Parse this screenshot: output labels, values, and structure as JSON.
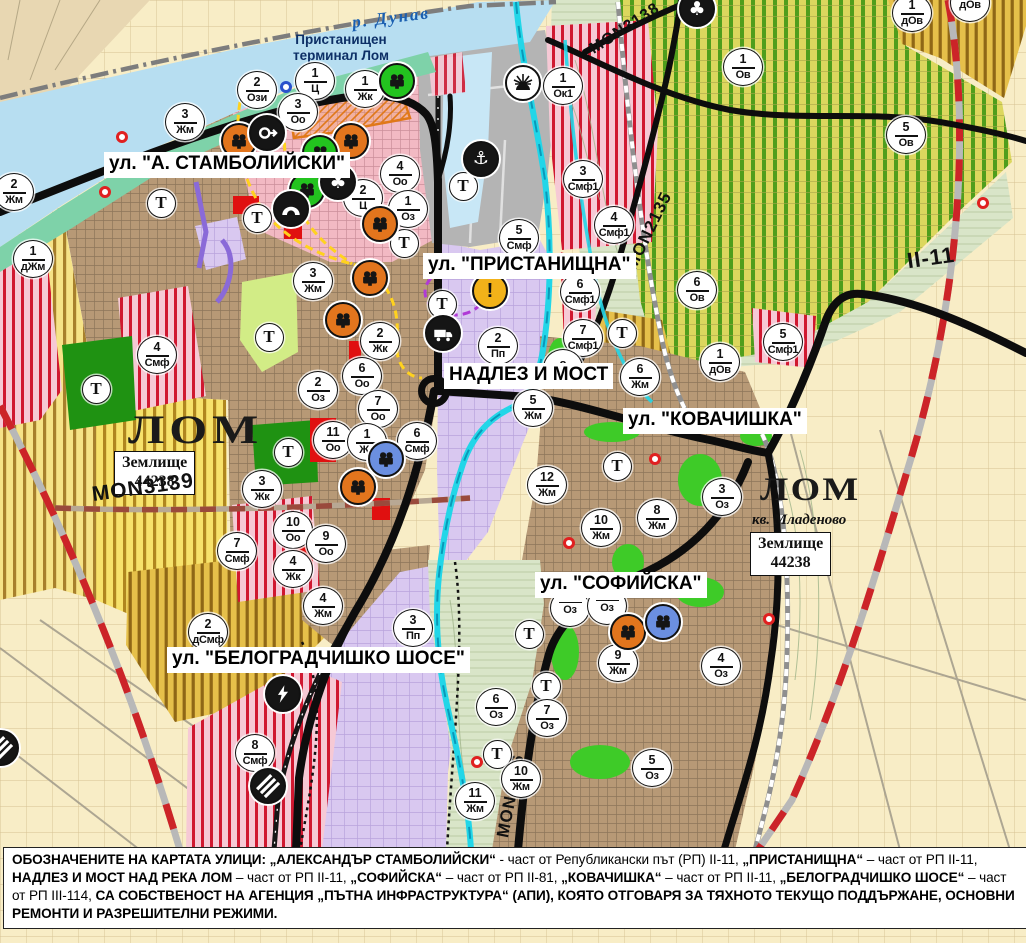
{
  "map": {
    "t_letter": "Т",
    "places": {
      "danube": "р. Дунав",
      "terminal_line1": "Пристанищен",
      "terminal_line2": "терминал Лом",
      "lom": "ЛОМ",
      "mladenovo": "кв. Младеново",
      "zemlishte_word": "Землище",
      "zemlishte_number": "44238"
    },
    "street_labels": [
      {
        "text": "ул. \"А. СТАМБОЛИЙСКИ\"",
        "x": 104,
        "y": 152
      },
      {
        "text": "ул. \"ПРИСТАНИЩНА\"",
        "x": 423,
        "y": 253
      },
      {
        "text": "НАДЛЕЗ И МОСТ",
        "x": 444,
        "y": 363
      },
      {
        "text": "ул. \"КОВАЧИШКА\"",
        "x": 623,
        "y": 408
      },
      {
        "text": "ул. \"СОФИЙСКА\"",
        "x": 535,
        "y": 572
      },
      {
        "text": "ул. \"БЕЛОГРАДЧИШКО ШОСЕ\"",
        "x": 167,
        "y": 647
      }
    ],
    "road_labels": [
      {
        "text": "MON3139",
        "x": 143,
        "y": 490,
        "rot": -8,
        "fs": 21
      },
      {
        "text": "MON2135",
        "x": 649,
        "y": 232,
        "rot": -64,
        "fs": 17
      },
      {
        "text": "MON3138",
        "x": 625,
        "y": 30,
        "rot": -33,
        "fs": 16
      },
      {
        "text": "MON2136",
        "x": 511,
        "y": 797,
        "rot": -79,
        "fs": 17
      },
      {
        "text": "II-11",
        "x": 931,
        "y": 259,
        "rot": -8,
        "fs": 22
      }
    ],
    "zone_markers": [
      {
        "x": 14,
        "y": 192,
        "n": "2",
        "c": "Жм"
      },
      {
        "x": 33,
        "y": 259,
        "n": "1",
        "c": "дЖм"
      },
      {
        "x": 185,
        "y": 122,
        "n": "3",
        "c": "Жм"
      },
      {
        "x": 257,
        "y": 90,
        "n": "2",
        "c": "Ози"
      },
      {
        "x": 315,
        "y": 81,
        "n": "1",
        "c": "Ц"
      },
      {
        "x": 365,
        "y": 89,
        "n": "1",
        "c": "Жк"
      },
      {
        "x": 298,
        "y": 112,
        "n": "3",
        "c": "Оо"
      },
      {
        "x": 400,
        "y": 174,
        "n": "4",
        "c": "Оо"
      },
      {
        "x": 363,
        "y": 198,
        "n": "2",
        "c": "Ц"
      },
      {
        "x": 408,
        "y": 209,
        "n": "1",
        "c": "Оз"
      },
      {
        "x": 563,
        "y": 86,
        "n": "1",
        "c": "Ок1"
      },
      {
        "x": 583,
        "y": 179,
        "n": "3",
        "c": "Смф1"
      },
      {
        "x": 614,
        "y": 225,
        "n": "4",
        "c": "Смф1"
      },
      {
        "x": 519,
        "y": 238,
        "n": "5",
        "c": "Смф"
      },
      {
        "x": 157,
        "y": 355,
        "n": "4",
        "c": "Смф"
      },
      {
        "x": 313,
        "y": 281,
        "n": "3",
        "c": "Жм"
      },
      {
        "x": 380,
        "y": 341,
        "n": "2",
        "c": "Жк"
      },
      {
        "x": 580,
        "y": 292,
        "n": "6",
        "c": "Смф1"
      },
      {
        "x": 583,
        "y": 338,
        "n": "7",
        "c": "Смф1"
      },
      {
        "x": 697,
        "y": 290,
        "n": "6",
        "c": "Ов"
      },
      {
        "x": 743,
        "y": 67,
        "n": "1",
        "c": "Ов"
      },
      {
        "x": 906,
        "y": 135,
        "n": "5",
        "c": "Ов"
      },
      {
        "x": 912,
        "y": 13,
        "n": "1",
        "c": "дОв"
      },
      {
        "x": 970,
        "y": 3,
        "n": "",
        "c": "дОв"
      },
      {
        "x": 720,
        "y": 362,
        "n": "1",
        "c": "дОв"
      },
      {
        "x": 783,
        "y": 342,
        "n": "5",
        "c": "Смф1"
      },
      {
        "x": 498,
        "y": 346,
        "n": "2",
        "c": "Пп"
      },
      {
        "x": 563,
        "y": 368,
        "n": "8",
        "c": ""
      },
      {
        "x": 533,
        "y": 408,
        "n": "5",
        "c": "Жм"
      },
      {
        "x": 640,
        "y": 377,
        "n": "6",
        "c": "Жм"
      },
      {
        "x": 318,
        "y": 390,
        "n": "2",
        "c": "Оз"
      },
      {
        "x": 362,
        "y": 376,
        "n": "6",
        "c": "Оо"
      },
      {
        "x": 378,
        "y": 409,
        "n": "7",
        "c": "Оо"
      },
      {
        "x": 333,
        "y": 440,
        "n": "11",
        "c": "Оо"
      },
      {
        "x": 367,
        "y": 442,
        "n": "1",
        "c": "Жс"
      },
      {
        "x": 417,
        "y": 441,
        "n": "6",
        "c": "Смф"
      },
      {
        "x": 262,
        "y": 489,
        "n": "3",
        "c": "Жк"
      },
      {
        "x": 293,
        "y": 530,
        "n": "10",
        "c": "Оо"
      },
      {
        "x": 326,
        "y": 544,
        "n": "9",
        "c": "Оо"
      },
      {
        "x": 293,
        "y": 569,
        "n": "4",
        "c": "Жк"
      },
      {
        "x": 237,
        "y": 551,
        "n": "7",
        "c": "Смф"
      },
      {
        "x": 208,
        "y": 632,
        "n": "2",
        "c": "дСмф"
      },
      {
        "x": 323,
        "y": 606,
        "n": "4",
        "c": "Жм"
      },
      {
        "x": 413,
        "y": 628,
        "n": "3",
        "c": "Пп"
      },
      {
        "x": 255,
        "y": 753,
        "n": "8",
        "c": "Смф"
      },
      {
        "x": 547,
        "y": 485,
        "n": "12",
        "c": "Жм"
      },
      {
        "x": 601,
        "y": 528,
        "n": "10",
        "c": "Жм"
      },
      {
        "x": 657,
        "y": 518,
        "n": "8",
        "c": "Жм"
      },
      {
        "x": 722,
        "y": 497,
        "n": "3",
        "c": "Оз"
      },
      {
        "x": 570,
        "y": 608,
        "n": "",
        "c": "Оз"
      },
      {
        "x": 607,
        "y": 606,
        "n": "",
        "c": "Оз"
      },
      {
        "x": 618,
        "y": 663,
        "n": "9",
        "c": "Жм"
      },
      {
        "x": 496,
        "y": 707,
        "n": "6",
        "c": "Оз"
      },
      {
        "x": 547,
        "y": 718,
        "n": "7",
        "c": "Оз"
      },
      {
        "x": 521,
        "y": 779,
        "n": "10",
        "c": "Жм"
      },
      {
        "x": 475,
        "y": 801,
        "n": "11",
        "c": "Жм"
      },
      {
        "x": 652,
        "y": 768,
        "n": "5",
        "c": "Оз"
      },
      {
        "x": 721,
        "y": 666,
        "n": "4",
        "c": "Оз"
      }
    ],
    "t_markers": [
      {
        "x": 161,
        "y": 203
      },
      {
        "x": 257,
        "y": 218
      },
      {
        "x": 463,
        "y": 186
      },
      {
        "x": 404,
        "y": 243
      },
      {
        "x": 442,
        "y": 304
      },
      {
        "x": 269,
        "y": 337
      },
      {
        "x": 96,
        "y": 389
      },
      {
        "x": 288,
        "y": 452
      },
      {
        "x": 622,
        "y": 333
      },
      {
        "x": 617,
        "y": 466
      },
      {
        "x": 529,
        "y": 634
      },
      {
        "x": 546,
        "y": 686
      },
      {
        "x": 497,
        "y": 754
      }
    ],
    "icon_markers": [
      {
        "x": 239,
        "y": 141,
        "type": "heritage",
        "color": "orange"
      },
      {
        "x": 351,
        "y": 141,
        "type": "heritage",
        "color": "orange"
      },
      {
        "x": 380,
        "y": 224,
        "type": "heritage",
        "color": "orange"
      },
      {
        "x": 370,
        "y": 278,
        "type": "heritage",
        "color": "orange"
      },
      {
        "x": 343,
        "y": 320,
        "type": "heritage",
        "color": "orange"
      },
      {
        "x": 358,
        "y": 487,
        "type": "heritage",
        "color": "orange"
      },
      {
        "x": 628,
        "y": 632,
        "type": "heritage",
        "color": "orange"
      },
      {
        "x": 397,
        "y": 81,
        "type": "heritage",
        "color": "green"
      },
      {
        "x": 320,
        "y": 153,
        "type": "heritage",
        "color": "green"
      },
      {
        "x": 307,
        "y": 190,
        "type": "heritage",
        "color": "green"
      },
      {
        "x": 386,
        "y": 459,
        "type": "heritage",
        "color": "blue"
      },
      {
        "x": 663,
        "y": 622,
        "type": "heritage",
        "color": "blue"
      },
      {
        "x": 267,
        "y": 133,
        "type": "keyhole",
        "color": "black"
      },
      {
        "x": 338,
        "y": 182,
        "type": "club",
        "color": "black"
      },
      {
        "x": 291,
        "y": 209,
        "type": "tunnel",
        "color": "black"
      },
      {
        "x": 443,
        "y": 333,
        "type": "truck",
        "color": "black"
      },
      {
        "x": 481,
        "y": 159,
        "type": "anchor",
        "color": "black"
      },
      {
        "x": 523,
        "y": 83,
        "type": "sun",
        "color": "white"
      },
      {
        "x": 490,
        "y": 291,
        "type": "warning",
        "color": "yellow"
      },
      {
        "x": 283,
        "y": 694,
        "type": "lightning",
        "color": "black"
      },
      {
        "x": 268,
        "y": 786,
        "type": "crossing",
        "color": "black"
      },
      {
        "x": 697,
        "y": 9,
        "type": "club",
        "color": "black"
      },
      {
        "x": 1,
        "y": 748,
        "type": "crossing",
        "color": "black"
      }
    ],
    "dot_markers": [
      {
        "x": 122,
        "y": 137,
        "kind": "red"
      },
      {
        "x": 105,
        "y": 192,
        "kind": "red"
      },
      {
        "x": 655,
        "y": 459,
        "kind": "red"
      },
      {
        "x": 569,
        "y": 543,
        "kind": "red"
      },
      {
        "x": 769,
        "y": 619,
        "kind": "red"
      },
      {
        "x": 477,
        "y": 762,
        "kind": "red"
      },
      {
        "x": 983,
        "y": 203,
        "kind": "red"
      },
      {
        "x": 286,
        "y": 87,
        "kind": "blue"
      }
    ]
  },
  "footer": {
    "segments": [
      {
        "t": "ОБОЗНАЧЕНИТЕ НА КАРТАТА УЛИЦИ: „АЛЕКСАНДЪР СТАМБОЛИЙСКИ“",
        "b": 1
      },
      {
        "t": " - част от Републикански път (РП) II-11, ",
        "b": 0
      },
      {
        "t": "„ПРИСТАНИЩНА“",
        "b": 1
      },
      {
        "t": " – част от РП II-11, ",
        "b": 0
      },
      {
        "t": "НАДЛЕЗ И МОСТ НАД РЕКА ЛОМ",
        "b": 1
      },
      {
        "t": " – част от РП II-11, ",
        "b": 0
      },
      {
        "t": "„СОФИЙСКА“",
        "b": 1
      },
      {
        "t": " – част от РП II-81, ",
        "b": 0
      },
      {
        "t": "„КОВАЧИШКА“",
        "b": 1
      },
      {
        "t": " – част от РП II-11, ",
        "b": 0
      },
      {
        "t": "„БЕЛОГРАДЧИШКО ШОСЕ“",
        "b": 1
      },
      {
        "t": " – част от РП III-114, ",
        "b": 0
      },
      {
        "t": "СА СОБСТВЕНОСТ НА АГЕНЦИЯ „ПЪТНА ИНФРАСТРУКТУРА“ (АПИ), КОЯТО ОТГОВАРЯ ЗА ТЯХНОТО ТЕКУЩО ПОДДЪРЖАНЕ, ОСНОВНИ РЕМОНТИ И РАЗРЕШИТЕЛНИ РЕЖИМИ.",
        "b": 1
      }
    ]
  }
}
